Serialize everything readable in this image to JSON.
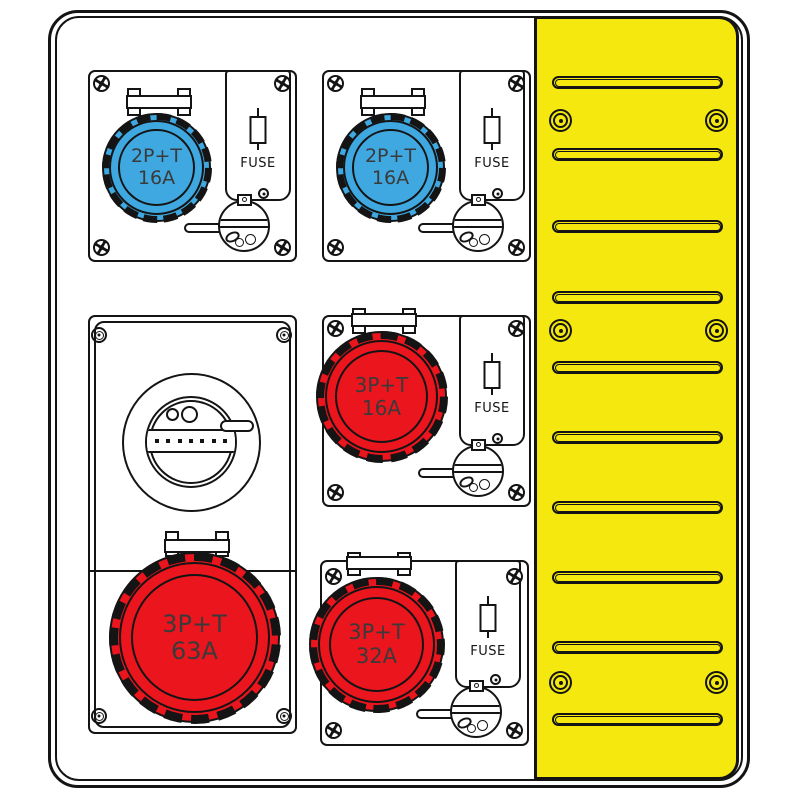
{
  "colors": {
    "panel_yellow": "#f5e80f",
    "socket_blue": "#3fa8e0",
    "socket_red": "#eb151e",
    "outline_black": "#141414",
    "enclosure_white": "#ffffff",
    "label_gray": "#3a3a3a"
  },
  "modules": {
    "top_left": {
      "rating_line1": "2P+T",
      "rating_line2": "16A",
      "fuse_label": "FUSE"
    },
    "top_right": {
      "rating_line1": "2P+T",
      "rating_line2": "16A",
      "fuse_label": "FUSE"
    },
    "mid_right": {
      "rating_line1": "3P+T",
      "rating_line2": "16A",
      "fuse_label": "FUSE"
    },
    "left_tall": {
      "rating_line1": "3P+T",
      "rating_line2": "63A"
    },
    "bottom_right": {
      "rating_line1": "3P+T",
      "rating_line2": "32A",
      "fuse_label": "FUSE"
    }
  },
  "yellow_panel": {
    "vent_slot_count": 10,
    "screw_pair_count": 3
  }
}
